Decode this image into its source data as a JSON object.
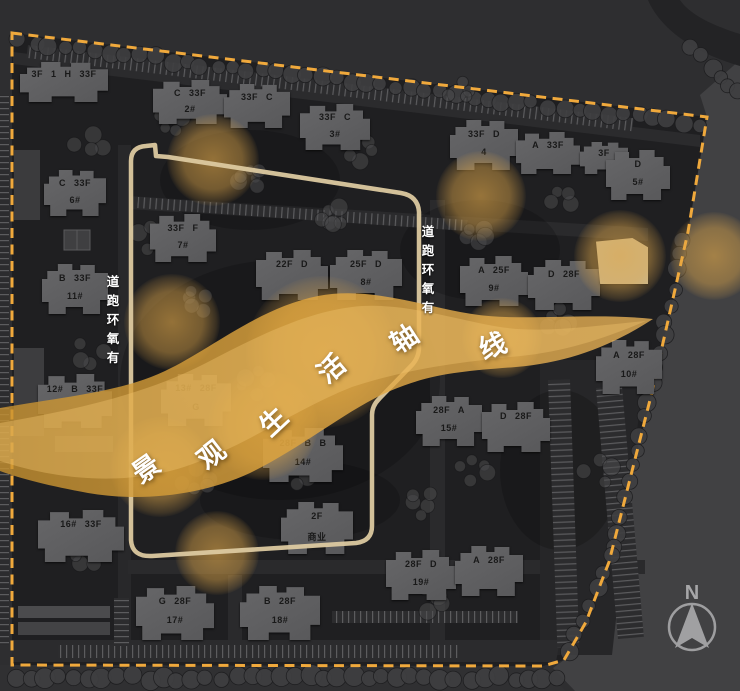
{
  "axis": {
    "label": "景观生活轴线",
    "characters": [
      {
        "char": "景",
        "x": 145,
        "y": 467,
        "rot": -35
      },
      {
        "char": "观",
        "x": 210,
        "y": 453,
        "rot": -38
      },
      {
        "char": "生",
        "x": 272,
        "y": 420,
        "rot": -43
      },
      {
        "char": "活",
        "x": 330,
        "y": 367,
        "rot": -40
      },
      {
        "char": "轴",
        "x": 403,
        "y": 337,
        "rot": -33
      },
      {
        "char": "线",
        "x": 492,
        "y": 344,
        "rot": -22
      }
    ]
  },
  "track": {
    "label": "有氧环跑道",
    "chars_top_to_bottom": [
      "道",
      "跑",
      "环",
      "氧",
      "有"
    ],
    "columns": [
      {
        "x": 113,
        "y": 276
      },
      {
        "x": 428,
        "y": 226
      }
    ]
  },
  "north": {
    "label": "N"
  },
  "buildings": [
    {
      "x": 20,
      "y": 62,
      "w": 88,
      "h": 40,
      "top": "3F 1 H 33F",
      "bottom": ""
    },
    {
      "x": 153,
      "y": 80,
      "w": 74,
      "h": 44,
      "top": "C 33F",
      "bottom": "2#"
    },
    {
      "x": 224,
      "y": 84,
      "w": 66,
      "h": 44,
      "top": "33F C",
      "bottom": ""
    },
    {
      "x": 300,
      "y": 104,
      "w": 70,
      "h": 46,
      "top": "33F C",
      "bottom": "3#"
    },
    {
      "x": 450,
      "y": 120,
      "w": 68,
      "h": 50,
      "top": "33F D",
      "bottom": "4"
    },
    {
      "x": 516,
      "y": 132,
      "w": 64,
      "h": 42,
      "top": "A 33F",
      "bottom": ""
    },
    {
      "x": 580,
      "y": 142,
      "w": 48,
      "h": 32,
      "top": "3F",
      "bottom": ""
    },
    {
      "x": 606,
      "y": 150,
      "w": 64,
      "h": 50,
      "top": "D",
      "bottom": "5#"
    },
    {
      "x": 44,
      "y": 170,
      "w": 62,
      "h": 46,
      "top": "C 33F",
      "bottom": "6#"
    },
    {
      "x": 150,
      "y": 214,
      "w": 66,
      "h": 48,
      "top": "33F F",
      "bottom": "7#"
    },
    {
      "x": 42,
      "y": 264,
      "w": 66,
      "h": 50,
      "top": "B 33F",
      "bottom": "11#"
    },
    {
      "x": 256,
      "y": 250,
      "w": 72,
      "h": 50,
      "top": "22F D",
      "bottom": ""
    },
    {
      "x": 330,
      "y": 250,
      "w": 72,
      "h": 50,
      "top": "25F D",
      "bottom": "8#"
    },
    {
      "x": 460,
      "y": 256,
      "w": 68,
      "h": 50,
      "top": "A 25F",
      "bottom": "9#"
    },
    {
      "x": 528,
      "y": 260,
      "w": 72,
      "h": 50,
      "top": "D 28F",
      "bottom": ""
    },
    {
      "x": 38,
      "y": 374,
      "w": 74,
      "h": 54,
      "top": "12# B 33F",
      "bottom": ""
    },
    {
      "x": 161,
      "y": 374,
      "w": 70,
      "h": 52,
      "top": "13# 28F",
      "bottom": "G"
    },
    {
      "x": 263,
      "y": 428,
      "w": 80,
      "h": 54,
      "top": "28F B B",
      "bottom": "14#"
    },
    {
      "x": 416,
      "y": 396,
      "w": 66,
      "h": 50,
      "top": "28F A",
      "bottom": "15#"
    },
    {
      "x": 482,
      "y": 402,
      "w": 68,
      "h": 50,
      "top": "D 28F",
      "bottom": ""
    },
    {
      "x": 596,
      "y": 340,
      "w": 66,
      "h": 54,
      "top": "A 28F",
      "bottom": "10#"
    },
    {
      "x": 38,
      "y": 510,
      "w": 86,
      "h": 52,
      "top": "16# 33F",
      "bottom": ""
    },
    {
      "x": 281,
      "y": 502,
      "w": 72,
      "h": 52,
      "top": "2F",
      "bottom": "商业"
    },
    {
      "x": 386,
      "y": 550,
      "w": 70,
      "h": 50,
      "top": "28F D",
      "bottom": "19#"
    },
    {
      "x": 455,
      "y": 546,
      "w": 68,
      "h": 50,
      "top": "A 28F",
      "bottom": ""
    },
    {
      "x": 136,
      "y": 586,
      "w": 78,
      "h": 54,
      "top": "G 28F",
      "bottom": "17#"
    },
    {
      "x": 240,
      "y": 586,
      "w": 80,
      "h": 54,
      "top": "B 28F",
      "bottom": "18#"
    },
    {
      "x": 596,
      "y": 238,
      "w": 52,
      "h": 46,
      "top": "",
      "bottom": "",
      "lit": true
    }
  ],
  "glows": [
    {
      "x": 213,
      "y": 160,
      "r": 46
    },
    {
      "x": 172,
      "y": 322,
      "r": 48
    },
    {
      "x": 263,
      "y": 425,
      "r": 55
    },
    {
      "x": 322,
      "y": 352,
      "r": 76
    },
    {
      "x": 481,
      "y": 196,
      "r": 45
    },
    {
      "x": 620,
      "y": 256,
      "r": 46
    },
    {
      "x": 160,
      "y": 467,
      "r": 50
    },
    {
      "x": 217,
      "y": 553,
      "r": 42
    },
    {
      "x": 502,
      "y": 338,
      "r": 40
    },
    {
      "x": 714,
      "y": 256,
      "r": 44
    }
  ],
  "colors": {
    "boundary_dash": "#f0a93c",
    "ribbon_dark": "#c8922f",
    "ribbon_light": "#f0c36d",
    "track_path": "#dcc9a0",
    "glow": "#dfa84e",
    "site_fill": "#1f1f21",
    "building_fill": "#5e5e60"
  }
}
